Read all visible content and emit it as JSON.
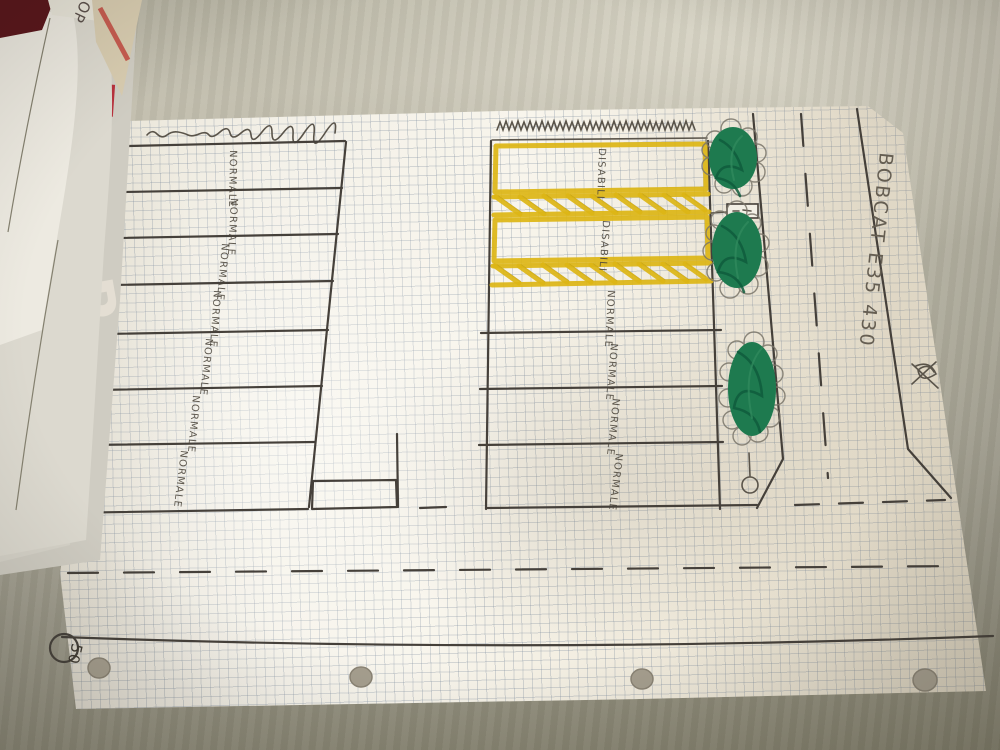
{
  "left_block": {
    "stalls": [
      {
        "label": "NORMALE"
      },
      {
        "label": "NORMALE"
      },
      {
        "label": "NORMALE"
      },
      {
        "label": "NORMALE"
      },
      {
        "label": "NORMALE"
      },
      {
        "label": "NORMALE"
      },
      {
        "label": "NORMALE"
      }
    ]
  },
  "middle_block": {
    "disabled_stalls": [
      {
        "label": "DISABILI"
      },
      {
        "label": "DISABILI"
      }
    ],
    "stalls": [
      {
        "label": "NORMALE"
      },
      {
        "label": "NORMALE"
      },
      {
        "label": "NORMALE"
      },
      {
        "label": "NORMALE"
      }
    ]
  },
  "annotations": {
    "machine_note": "BOBCAT E35 430",
    "speed_limit": "50"
  },
  "paper_stack": {
    "card_text": "OP",
    "magazine_letter": "P"
  },
  "colors": {
    "ink": "#45403a",
    "marking_yellow": "#dcb515",
    "tree_green": "#1e7a4f",
    "paper": "#f3f0e7",
    "tablecloth": "#b0ad9e"
  }
}
